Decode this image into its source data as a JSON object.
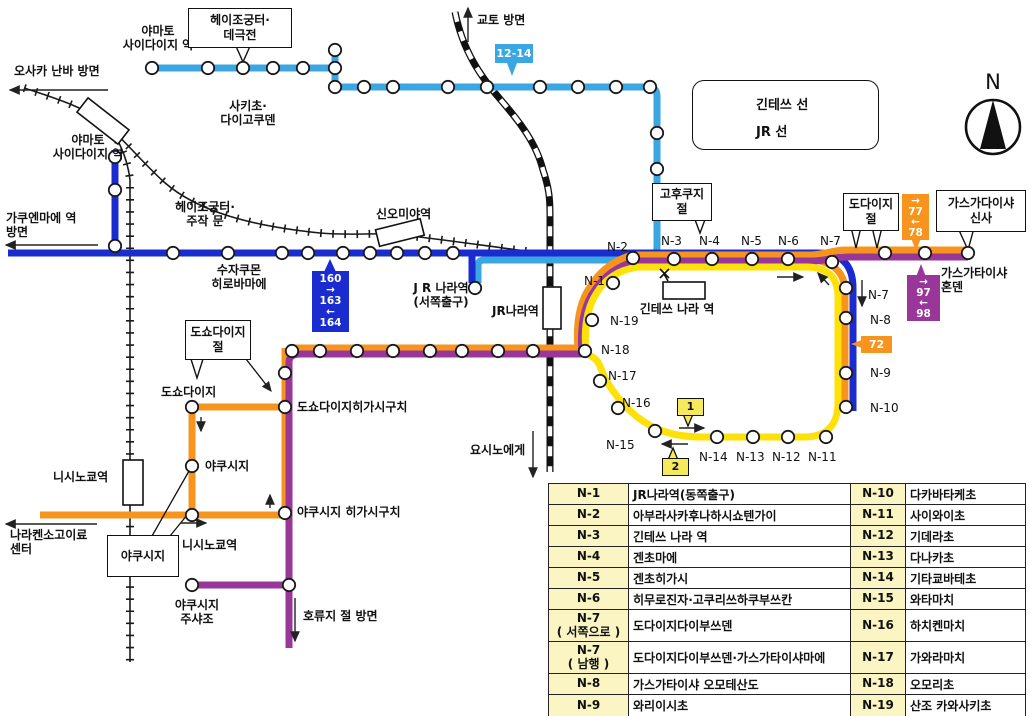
{
  "colors": {
    "light_blue": "#3BA7E2",
    "blue": "#1A2BD0",
    "orange": "#F7941E",
    "purple": "#993699",
    "yellow": "#FFE10A",
    "badge_yellow": "#F6E95C",
    "table_key_bg": "#FBF4C3",
    "line_black": "#111111"
  },
  "legend": {
    "kintetsu": "긴테쓰 선",
    "jr": "JR 선"
  },
  "compass": {
    "north": "N"
  },
  "labels": {
    "yamato_saidaiji_top": "야마토\n사이다이지 역",
    "heijo_daigokuden": "헤이조궁터·\n데극전",
    "sakicho_daigokuden": "사키초·\n다이고쿠덴",
    "osaka_namba": "오사카 난바 방면",
    "kyoto": "교토 방면",
    "yamato_saidaiji_left": "야마토\n사이다이지 역",
    "gakuenmae": "가쿠엔마에 역\n방면",
    "heijo_suzakumon": "헤이조궁터·\n주작 문",
    "shin_omiya": "신오미야역",
    "suzakumon_hirobamae": "수자쿠몬\n히로바마에",
    "jr_nara_west": "J R 나라역\n(서쪽출구)",
    "jr_nara": "JR나라역",
    "kintetsu_nara": "긴테쓰 나라 역",
    "kofukuji": "고후쿠지\n절",
    "todaiji": "도다이지\n절",
    "kasuga_shrine": "가스가다이샤\n신사",
    "kasuga_honden": "가스가타이샤\n혼덴",
    "yoshino": "요시노에게",
    "toshodaiji_temple": "도쇼다이지\n절",
    "toshodaiji": "도쇼다이지",
    "toshodaiji_higashiguchi": "도쇼다이지히가시구치",
    "yakushiji": "야쿠시지",
    "nishinokyo_station": "니시노쿄역",
    "yakushiji_higashiguchi": "야쿠시지 히가시구치",
    "nishinokyo_stop": "니시노쿄역",
    "yakushiji_box": "야쿠시지",
    "medical_center": "나라켄소고이료\n센터",
    "yakushiji_chushajo": "야쿠시지\n주샤조",
    "horyuji": "호류지 절 방면"
  },
  "marks": {
    "n1": "N-1",
    "n2": "N-2",
    "n3": "N-3",
    "n4": "N-4",
    "n5": "N-5",
    "n6": "N-6",
    "n7": "N-7",
    "n7_side": "N-7",
    "n8": "N-8",
    "n9": "N-9",
    "n10": "N-10",
    "n11": "N-11",
    "n12": "N-12",
    "n13": "N-13",
    "n14": "N-14",
    "n15": "N-15",
    "n16": "N-16",
    "n17": "N-17",
    "n18": "N-18",
    "n19": "N-19"
  },
  "badges": {
    "b1214": "12-14",
    "b160": "160\n→\n163\n←\n164",
    "b7778": "→\n77\n←\n78",
    "b9798": "→\n97\n←\n98",
    "b72": "72",
    "loop1": "1",
    "loop2": "2"
  },
  "table": {
    "rows": [
      {
        "k1": "N-1",
        "v1": "JR나라역(동쪽출구)",
        "k2": "N-10",
        "v2": "다카바타케초"
      },
      {
        "k1": "N-2",
        "v1": "아부라사카후나하시쇼텐가이",
        "k2": "N-11",
        "v2": "사이와이초"
      },
      {
        "k1": "N-3",
        "v1": "긴테쓰 나라 역",
        "k2": "N-12",
        "v2": "기데라초"
      },
      {
        "k1": "N-4",
        "v1": "겐초마에",
        "k2": "N-13",
        "v2": "다나카초"
      },
      {
        "k1": "N-5",
        "v1": "겐초히가시",
        "k2": "N-14",
        "v2": "기타쿄바테초"
      },
      {
        "k1": "N-6",
        "v1": "히무로진자·고쿠리쓰하쿠부쓰칸",
        "k2": "N-15",
        "v2": "와타마치"
      },
      {
        "k1": "N-7\n( 서쪽으로 )",
        "v1": "도다이지다이부쓰덴",
        "k2": "N-16",
        "v2": "하치켄마치"
      },
      {
        "k1": "N-7\n( 남행 )",
        "v1": "도다이지다이부쓰덴·가스가타이샤마에",
        "k2": "N-17",
        "v2": "가와라마치"
      },
      {
        "k1": "N-8",
        "v1": "가스가타이샤 오모테산도",
        "k2": "N-18",
        "v2": "오모리초"
      },
      {
        "k1": "N-9",
        "v1": "와리이시초",
        "k2": "N-19",
        "v2": "산조 카와사키초"
      }
    ]
  }
}
